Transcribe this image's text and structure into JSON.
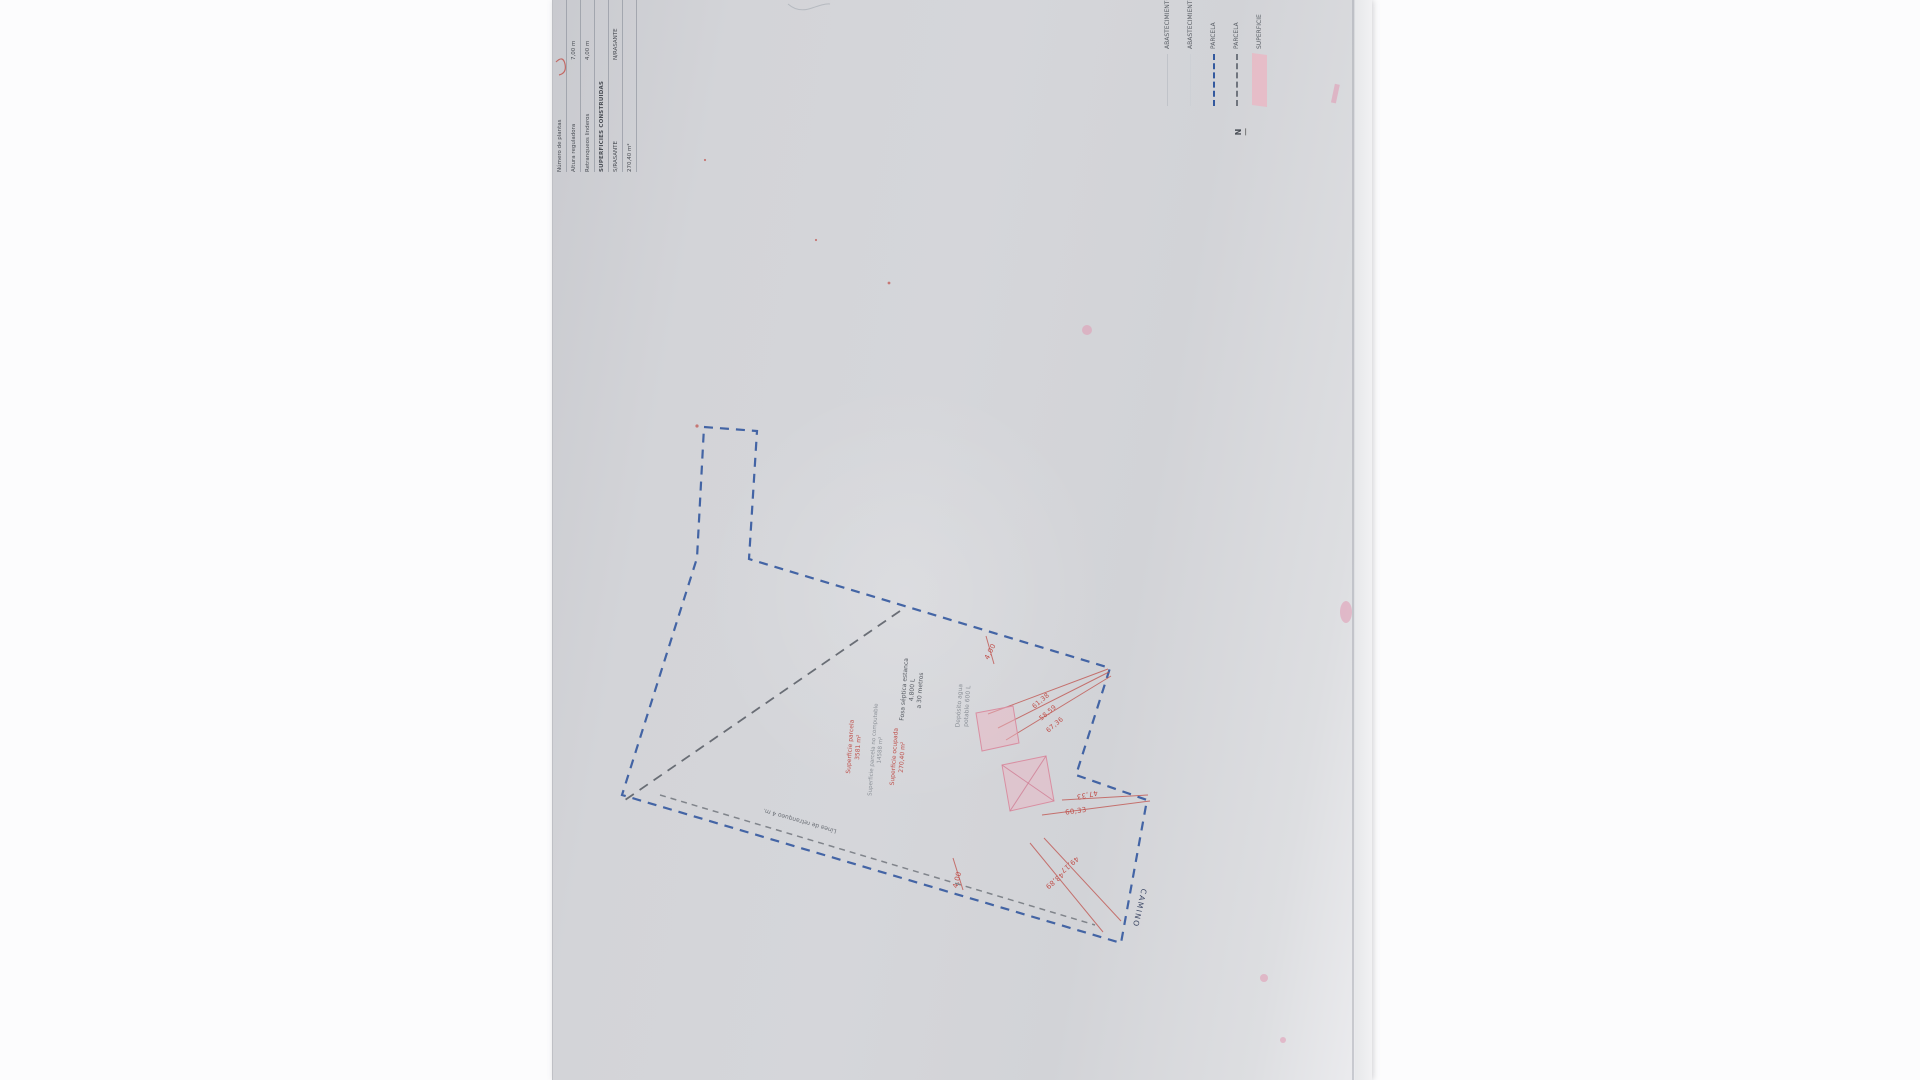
{
  "table": {
    "rows": [
      {
        "label": "Número de plantas",
        "value": ""
      },
      {
        "label": "Altura reguladora",
        "value": "7,00 m"
      },
      {
        "label": "Retranqueos linderos",
        "value": "4,00 m"
      }
    ],
    "section_header": "SUPERFICIES CONSTRUIDAS",
    "col1": "S/RASANTE",
    "col2": "N/RASANTE",
    "s_rasante_value": "270,40 m²"
  },
  "legend": {
    "items": [
      {
        "label": "ABASTECIMIENTO",
        "symbol": "thin-line"
      },
      {
        "label": "ABASTECIMIENTO",
        "symbol": "thin-line"
      },
      {
        "label": "PARCELA",
        "symbol": "blue-dashed-line"
      },
      {
        "label": "PARCELA",
        "symbol": "gray-dashed-line"
      },
      {
        "label": "SUPERFICIE",
        "symbol": "pink-swatch"
      }
    ]
  },
  "plan": {
    "north_label": "N",
    "road_label": "CAMINO",
    "setback_label": "Línea de retranqueo 4 m.",
    "surface_labels": {
      "parcela": {
        "l1": "Superficie parcela",
        "l2": "3581 m²"
      },
      "no_computable": {
        "l1": "Superficie parcela no computable",
        "l2": "14588 m²"
      },
      "ocupada": {
        "l1": "Superficie ocupada",
        "l2": "270,40 m²"
      }
    },
    "septic": {
      "l1": "Fosa séptica estanca",
      "l2": "4.800 L",
      "l3": "a 30 metros"
    },
    "water": {
      "l1": "Depósito agua",
      "l2": "potable 600 L"
    },
    "dims": [
      "4,00",
      "61,38",
      "58,59",
      "67,36",
      "47,33",
      "60,33",
      "49,17",
      "43,89",
      "4,00"
    ]
  },
  "colors": {
    "boundary": "#33589e",
    "setback": "#6a6f77",
    "interior": "#4d525b",
    "dim-red": "#bf4f4a",
    "pink-fill": "#eab6c3"
  }
}
